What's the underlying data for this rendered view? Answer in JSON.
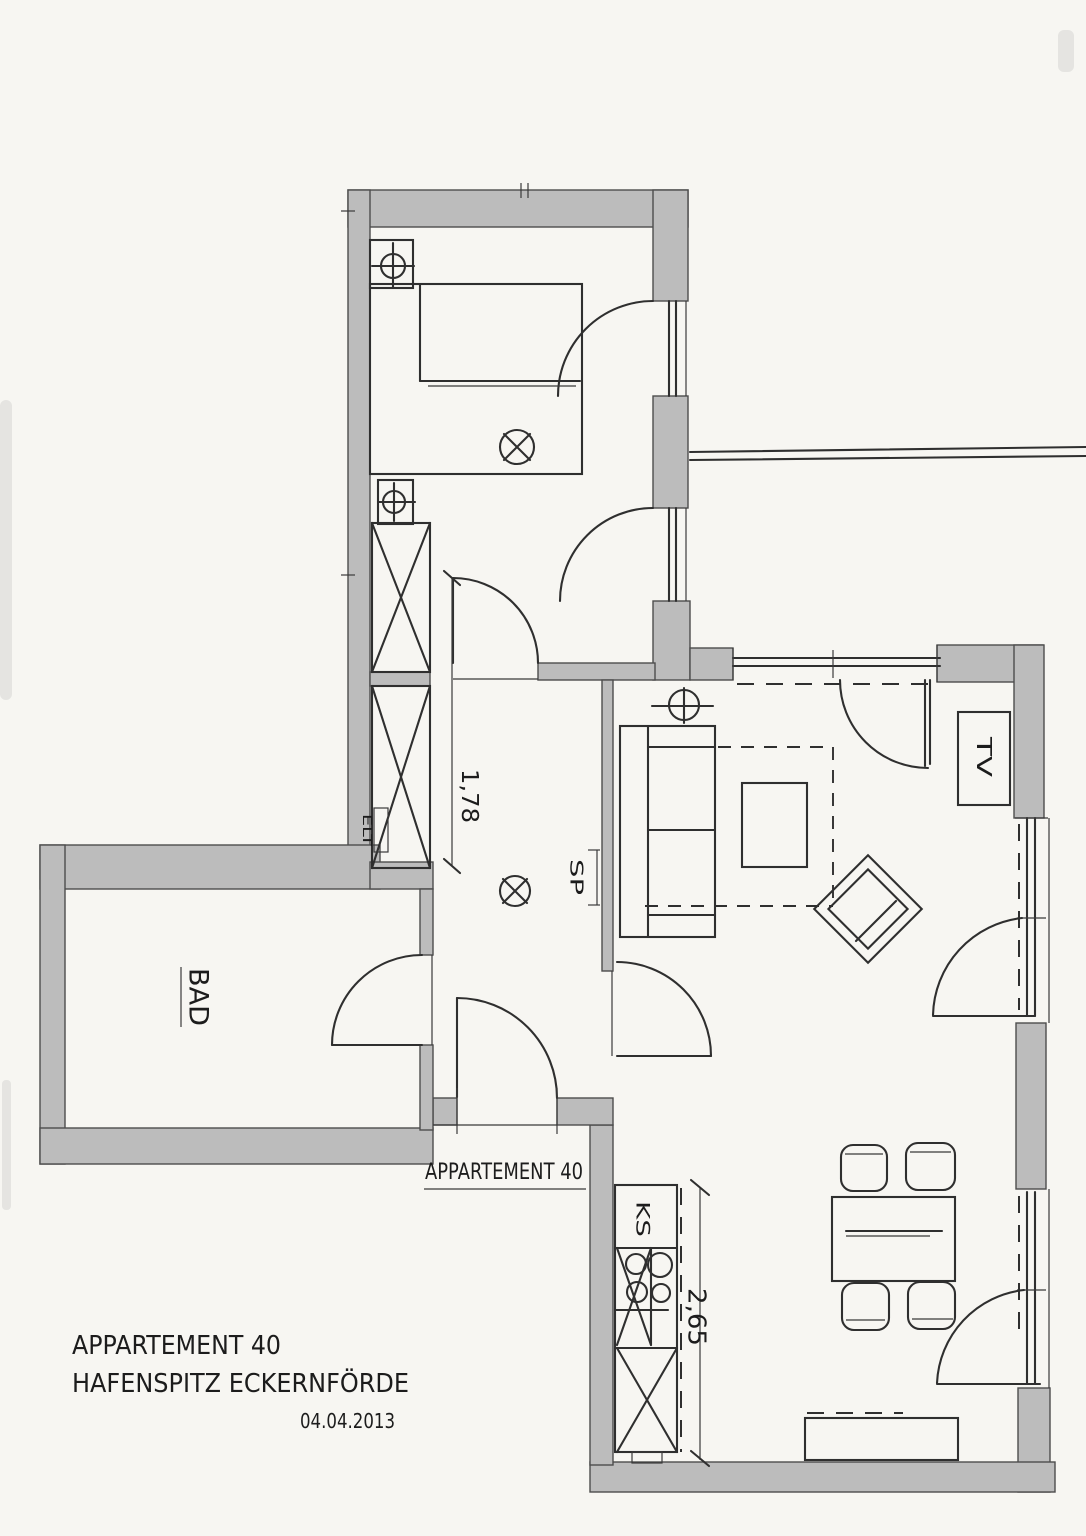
{
  "titleBlock": {
    "project": "APPARTEMENT 40",
    "location": "HAFENSPITZ ECKERNFÖRDE",
    "date": "04.04.2013"
  },
  "planLabels": {
    "unitDoor": "APPARTEMENT 40",
    "bathroom": "BAD",
    "tv": "TV",
    "fridge": "KS",
    "mirror": "SP",
    "electrical": "ELT"
  },
  "dimensions": {
    "hallway": "1,78",
    "kitchen": "2,65"
  },
  "colors": {
    "paper": "#f7f6f2",
    "wallFill": "#bcbcbc",
    "line": "#2f2f2f"
  }
}
